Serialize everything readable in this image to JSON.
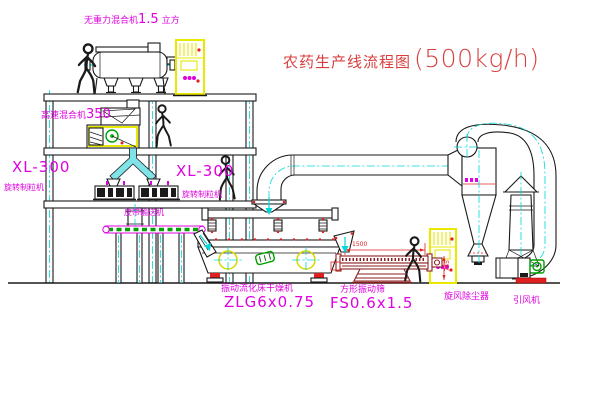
{
  "title": {
    "name": "农药生产线流程图",
    "capacity": "(500kg/h)"
  },
  "labels": {
    "gravity_mixer": {
      "name": "无重力混合机",
      "value": "1.5",
      "unit": "立方"
    },
    "high_speed_mixer": {
      "name": "高速混合机",
      "value": "350"
    },
    "granulator_left": {
      "model": "XL-300",
      "name": "旋转制粒机"
    },
    "granulator_right": {
      "model": "XL-300",
      "name": "旋转制粒机"
    },
    "belt_conveyor": "皮带输送机",
    "fluid_bed_dryer": {
      "name": "振动流化床干燥机",
      "model": "ZLG6x0.75"
    },
    "square_sieve": {
      "name": "方形振动筛",
      "model": "FS0.6x1.5"
    },
    "cyclone": "旋风除尘器",
    "induced_draft_fan": "引风机"
  },
  "dimensions": {
    "sieve_length": "1500",
    "sieve_height": "745"
  },
  "colors": {
    "line": "#1a1a1a",
    "label_magenta": "#e000e0",
    "centerline_cyan": "#00d8d8",
    "highlight_yellow": "#e8e800",
    "accent_green": "#00a000",
    "accent_red": "#e02020",
    "sieve_darkred": "#8b1f1f",
    "title_red": "#d84040",
    "background": "#ffffff"
  }
}
